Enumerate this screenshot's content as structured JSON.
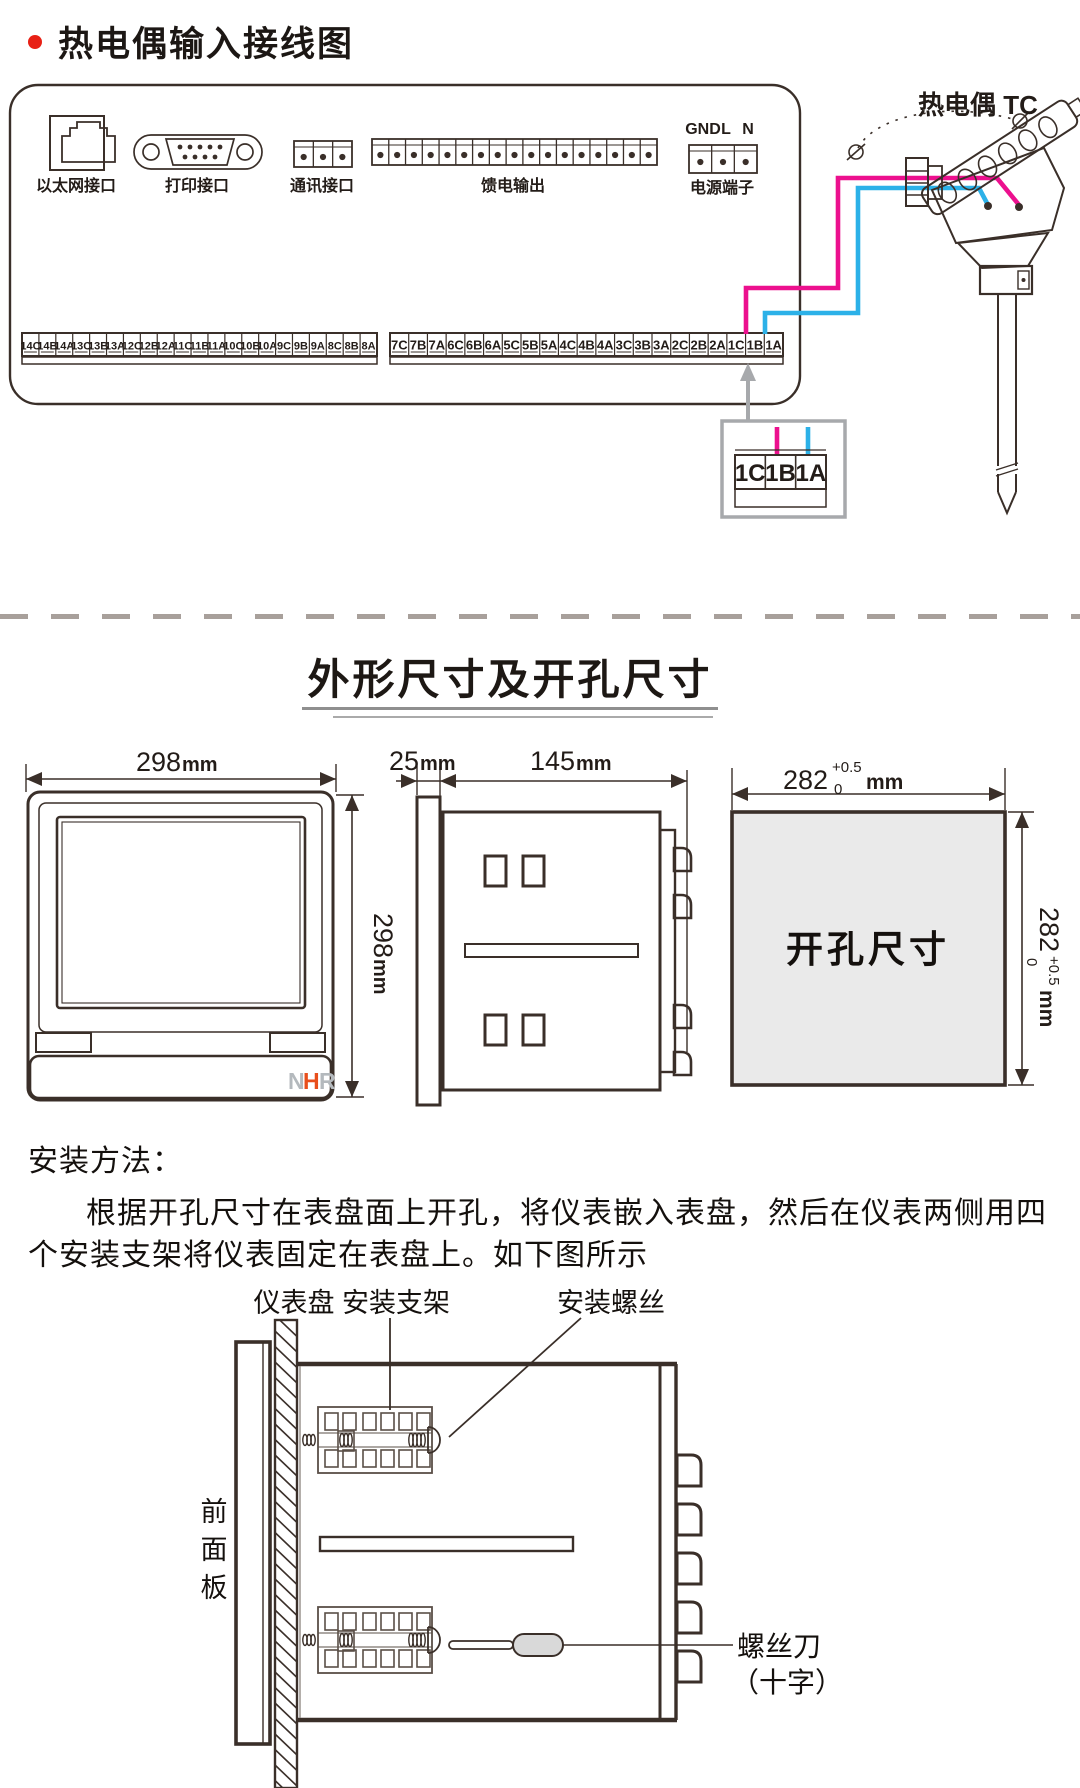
{
  "header": {
    "title": "热电偶输入接线图"
  },
  "wiring": {
    "ports": [
      {
        "label": "以太网接口"
      },
      {
        "label": "打印接口"
      },
      {
        "label": "通讯接口"
      },
      {
        "label": "馈电输出"
      },
      {
        "label": "电源端子"
      }
    ],
    "power_pins": [
      "GND",
      "L",
      "N"
    ],
    "sensor_title": "热电偶 TC",
    "left_terminals": [
      "14C",
      "14B",
      "14A",
      "13C",
      "13B",
      "13A",
      "12C",
      "12B",
      "12A",
      "11C",
      "11B",
      "11A",
      "10C",
      "10B",
      "10A",
      "9C",
      "9B",
      "9A",
      "8C",
      "8B",
      "8A"
    ],
    "right_terminals": [
      "7C",
      "7B",
      "7A",
      "6C",
      "6B",
      "6A",
      "5C",
      "5B",
      "5A",
      "4C",
      "4B",
      "4A",
      "3C",
      "3B",
      "3A",
      "2C",
      "2B",
      "2A",
      "1C",
      "1B",
      "1A"
    ],
    "detail_terminals": [
      "1C",
      "1B",
      "1A"
    ],
    "colors": {
      "wire_positive": "#ec108e",
      "wire_negative": "#2cb1e8",
      "ink": "#3a2f29",
      "gray": "#a7a9ac"
    }
  },
  "dims": {
    "section_title": "外形尺寸及开孔尺寸",
    "front_width": {
      "value": "298",
      "unit": "mm"
    },
    "front_height": {
      "value": "298",
      "unit": "mm"
    },
    "depth_bezel": {
      "value": "25",
      "unit": "mm"
    },
    "depth_body": {
      "value": "145",
      "unit": "mm"
    },
    "cutout_w": {
      "value": "282",
      "tol_top": "+0.5",
      "tol_bottom": "0",
      "unit": "mm"
    },
    "cutout_h": {
      "value": "282",
      "tol_top": "+0.5",
      "tol_bottom": "0",
      "unit": "mm"
    },
    "cutout_label": "开孔尺寸",
    "logo": {
      "n": "N",
      "h": "H",
      "r": "R"
    }
  },
  "install": {
    "heading": "安装方法：",
    "line1": "根据开孔尺寸在表盘面上开孔，将仪表嵌入表盘，然后在仪表两侧用四",
    "line2": "个安装支架将仪表固定在表盘上。如下图所示",
    "labels": {
      "panel": "仪表盘",
      "bracket": "安装支架",
      "screw": "安装螺丝",
      "front_panel": "前面板",
      "tool1": "螺丝刀",
      "tool2": "（十字）"
    }
  }
}
